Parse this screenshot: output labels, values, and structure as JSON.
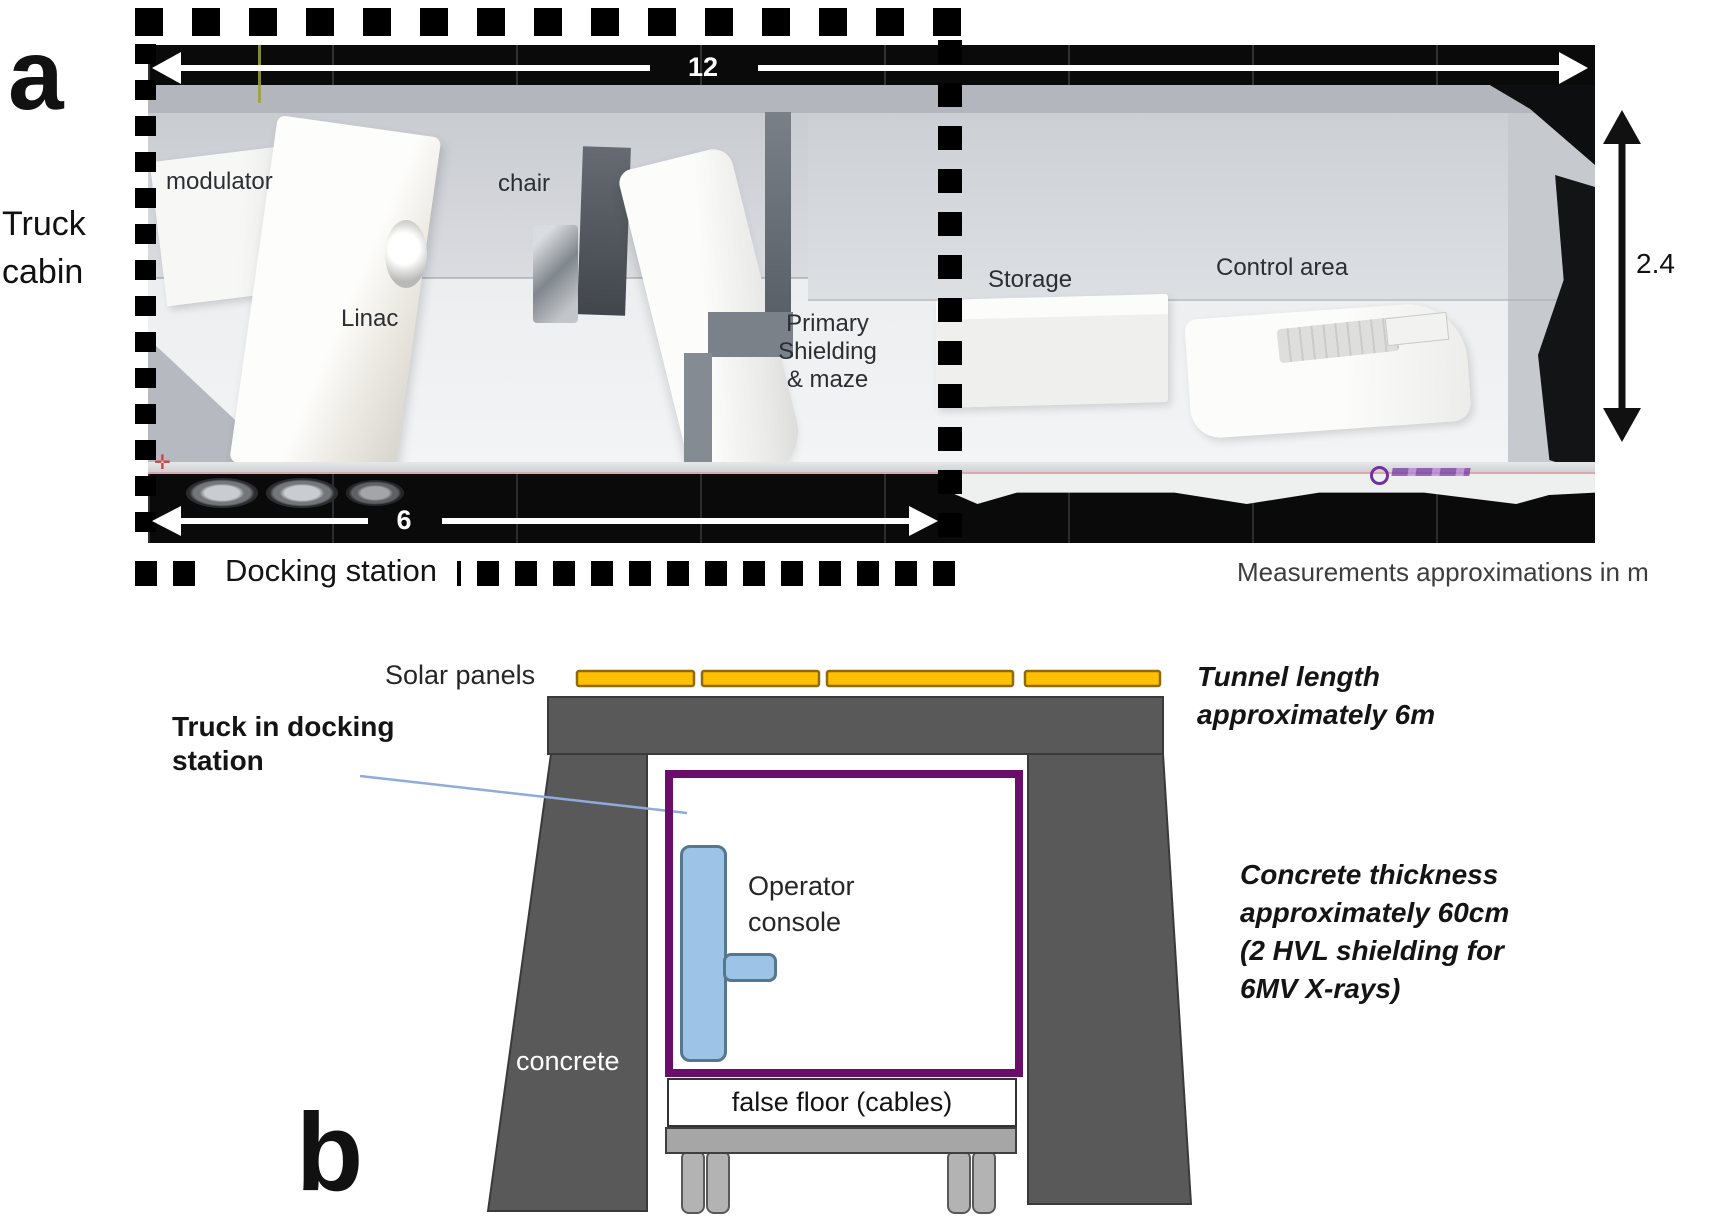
{
  "figure": {
    "panel_a": {
      "label": "a",
      "truck_cabin_lines": [
        "Truck",
        "cabin"
      ],
      "dims": {
        "length": "12",
        "tunnel": "6",
        "height": "2.4"
      },
      "room_labels": {
        "modulator": "modulator",
        "chair": "chair",
        "linac": "Linac",
        "shielding_lines": [
          "Primary",
          "Shielding",
          "& maze"
        ],
        "storage": "Storage",
        "control": "Control area"
      },
      "docking_station": "Docking station",
      "note": "Measurements approximations in m"
    },
    "panel_b": {
      "label": "b",
      "solar_panels": "Solar panels",
      "truck_in_docking_lines": [
        "Truck in docking",
        "station"
      ],
      "operator_console_lines": [
        "Operator",
        "console"
      ],
      "concrete": "concrete",
      "false_floor": "false floor (cables)",
      "tunnel_note_lines": [
        "Tunnel length",
        "approximately 6m"
      ],
      "concrete_note_lines": [
        "Concrete thickness",
        "approximately 60cm",
        "(2 HVL shielding for",
        "6MV X-rays)"
      ]
    },
    "colors": {
      "solar": "#FFC000",
      "solar_border": "#8F6A0A",
      "concrete": "#595959",
      "concrete_border": "#3A3A3A",
      "truck_outline": "#6B0D6B",
      "console": "#9DC3E6",
      "console_border": "#55788F",
      "annotation_line": "#8FAADC",
      "shelf": "#A6A6A6",
      "wheel": "#B3B3B3"
    }
  }
}
